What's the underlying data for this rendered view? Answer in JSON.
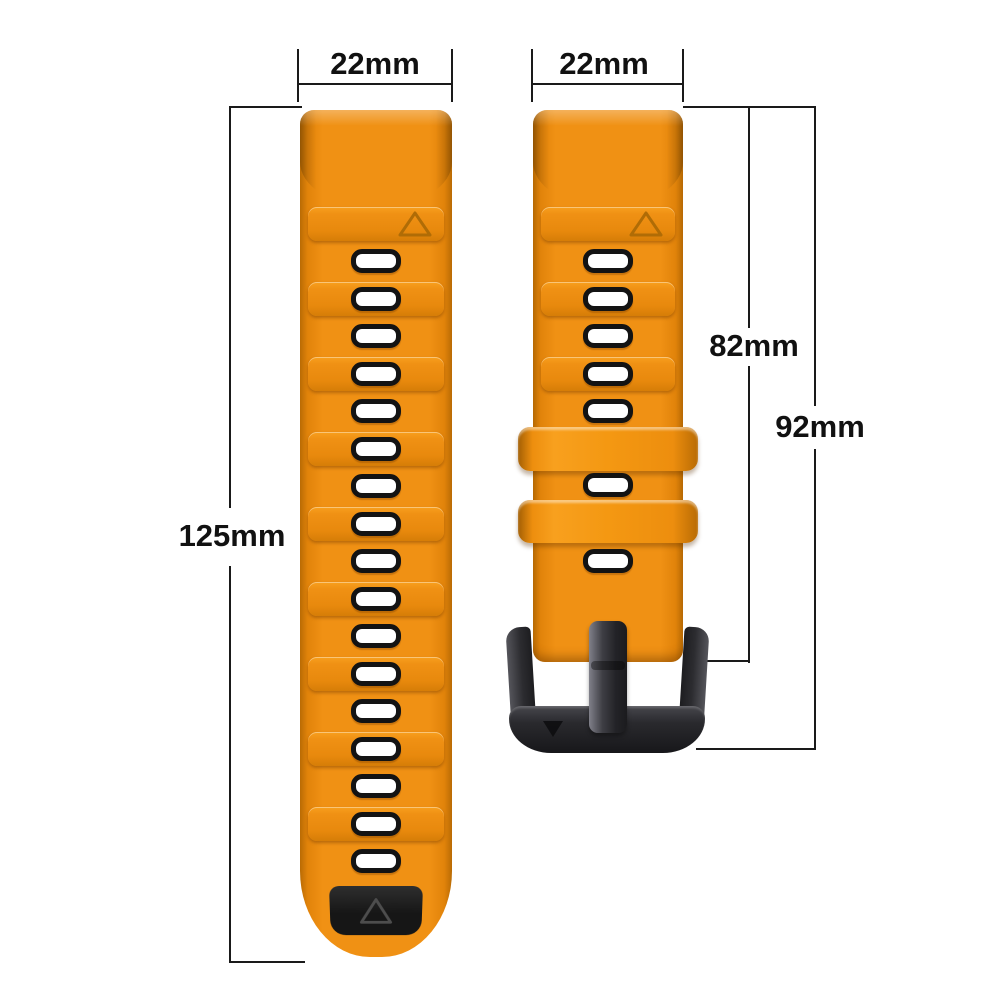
{
  "annotations": {
    "long_strap_width": {
      "label": "22mm"
    },
    "short_strap_width": {
      "label": "22mm"
    },
    "long_strap_length": {
      "label": "125mm"
    },
    "short_strap_length_to_buckle_frame": {
      "label": "82mm"
    },
    "short_strap_length_total": {
      "label": "92mm"
    }
  },
  "product": {
    "long_strap": {
      "hole_count": 17,
      "ridge_band_count": 9,
      "has_triangle_marker": true,
      "has_black_tip_panel": true
    },
    "short_strap": {
      "hole_count": 7,
      "ridge_band_count": 3,
      "keeper_count": 2,
      "has_triangle_marker": true,
      "has_pin_buckle": true
    }
  },
  "colors": {
    "strap_orange": "#F09114",
    "strap_orange_light": "#F8A01E",
    "strap_orange_dark": "#B96B04",
    "hole_fill": "#FFFFFF",
    "hole_border": "#131313",
    "tip_panel_black": "#161616",
    "buckle_dark": "#2A2A2E",
    "buckle_highlight": "#80808A",
    "dimension_line": "#1A1A1A",
    "label_text": "#111111",
    "background": "#FFFFFF"
  }
}
